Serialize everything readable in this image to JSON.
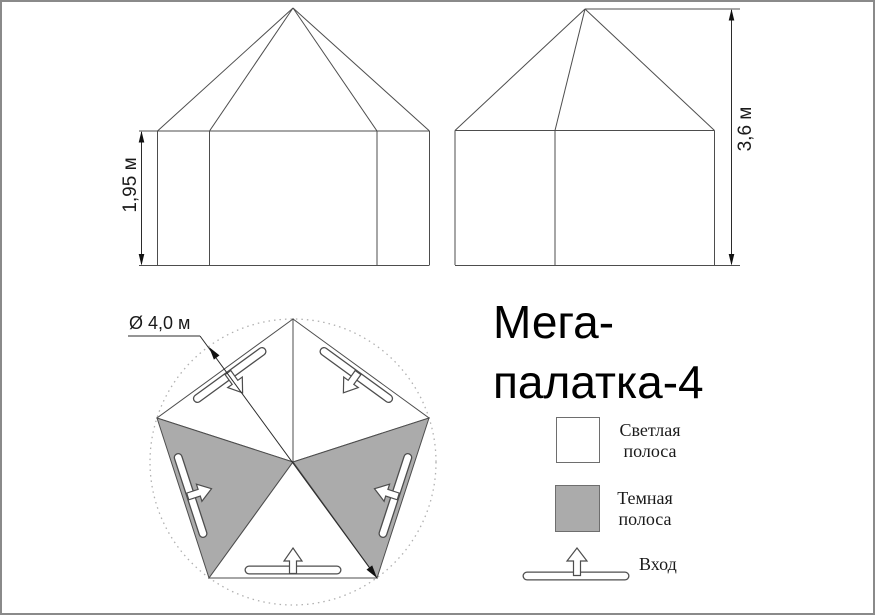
{
  "title": {
    "lines": [
      "Мега-",
      "палатка-4"
    ]
  },
  "dimensions": {
    "wall_height": "1,95 м",
    "total_height": "3,6 м",
    "diameter": "Ø 4,0 м"
  },
  "legend": {
    "light_label": [
      "Светлая",
      "полоса"
    ],
    "dark_label": [
      "Темная",
      "полоса"
    ],
    "entrance_label": "Вход"
  },
  "colors": {
    "dark_panel": "#ababab",
    "light_panel": "#ffffff",
    "line": "#4d4d4d",
    "frame": "#8a8a8a"
  }
}
